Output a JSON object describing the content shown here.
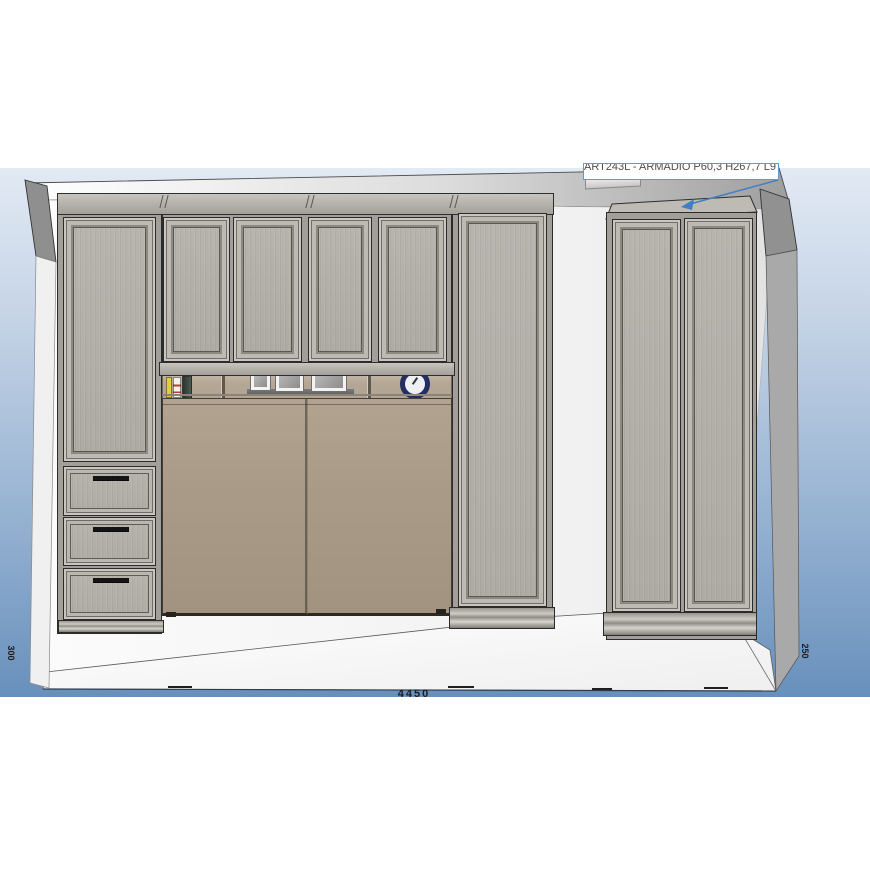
{
  "annotation": {
    "label": "ART243L - ARMADIO P60,3 H267,7 L97"
  },
  "dimensions": {
    "left_wall": "300",
    "right_wall": "250",
    "room_width": "4450"
  },
  "scene": {
    "type": "3d-furniture-elevation-view",
    "items": [
      "left-column-cabinet-with-door-and-3-drawers",
      "bridge-upper-cabinets-4-doors",
      "open-niche-with-books-picture-frames-clock",
      "fold-away-bed-panels",
      "right-column-tall-cabinet",
      "standalone-two-door-wardrobe"
    ],
    "colors": {
      "background_top": "#e2eaf4",
      "background_bottom": "#6890bc",
      "cabinet_face": "#b2b0a8",
      "bed_panel": "#a99b87",
      "wall_edge_gray": "#919191",
      "annotation_border": "#5b9bd5",
      "leader_line": "#3f7fc4"
    }
  }
}
